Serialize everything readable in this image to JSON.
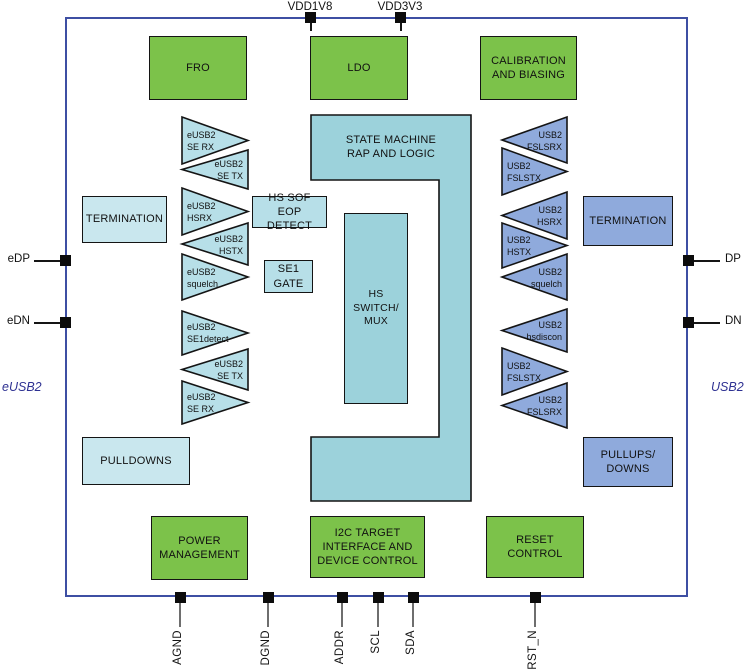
{
  "colors": {
    "green": "#7CC24A",
    "teal": "#9CD2DB",
    "teal-light": "#B7DFE8",
    "teal-pale": "#C9E7EE",
    "periwinkle": "#8FAADC",
    "border-blue": "#3E4FA3",
    "accent-blue": "#2E3192"
  },
  "diagram": {
    "side_labels": {
      "left": "eUSB2",
      "right": "USB2"
    },
    "pins": {
      "top": [
        "VDD1V8",
        "VDD3V3"
      ],
      "bottom": [
        "AGND",
        "DGND",
        "ADDR",
        "SCL",
        "SDA",
        "RST_N"
      ],
      "left": [
        "eDP",
        "eDN"
      ],
      "right": [
        "DP",
        "DN"
      ]
    },
    "blocks": {
      "fro": "FRO",
      "ldo": "LDO",
      "calibration": "CALIBRATION AND BIASING",
      "state_machine": "STATE MACHINE RAP AND LOGIC",
      "hs_switch_mux": "HS SWITCH/ MUX",
      "hs_sof_eop_detect": "HS SOF EOP DETECT",
      "se1_gate": "SE1 GATE",
      "termination_left": "TERMINATION",
      "termination_right": "TERMINATION",
      "pulldowns": "PULLDOWNS",
      "pullups_downs": "PULLUPS/ DOWNS",
      "power_management": "POWER MANAGEMENT",
      "i2c": "I2C TARGET INTERFACE AND DEVICE CONTROL",
      "reset_control": "RESET CONTROL"
    },
    "left_triangles": [
      {
        "l1": "eUSB2",
        "l2": "SE RX"
      },
      {
        "l1": "eUSB2",
        "l2": "SE TX"
      },
      {
        "l1": "eUSB2",
        "l2": "HSRX"
      },
      {
        "l1": "eUSB2",
        "l2": "HSTX"
      },
      {
        "l1": "eUSB2",
        "l2": "squelch"
      },
      {
        "l1": "eUSB2",
        "l2": "SE1detect"
      },
      {
        "l1": "eUSB2",
        "l2": "SE TX"
      },
      {
        "l1": "eUSB2",
        "l2": "SE RX"
      }
    ],
    "right_triangles": [
      {
        "l1": "USB2",
        "l2": "FSLSRX"
      },
      {
        "l1": "USB2",
        "l2": "FSLSTX"
      },
      {
        "l1": "USB2",
        "l2": "HSRX"
      },
      {
        "l1": "USB2",
        "l2": "HSTX"
      },
      {
        "l1": "USB2",
        "l2": "squelch"
      },
      {
        "l1": "USB2",
        "l2": "hsdiscon"
      },
      {
        "l1": "USB2",
        "l2": "FSLSTX"
      },
      {
        "l1": "USB2",
        "l2": "FSLSRX"
      }
    ]
  }
}
